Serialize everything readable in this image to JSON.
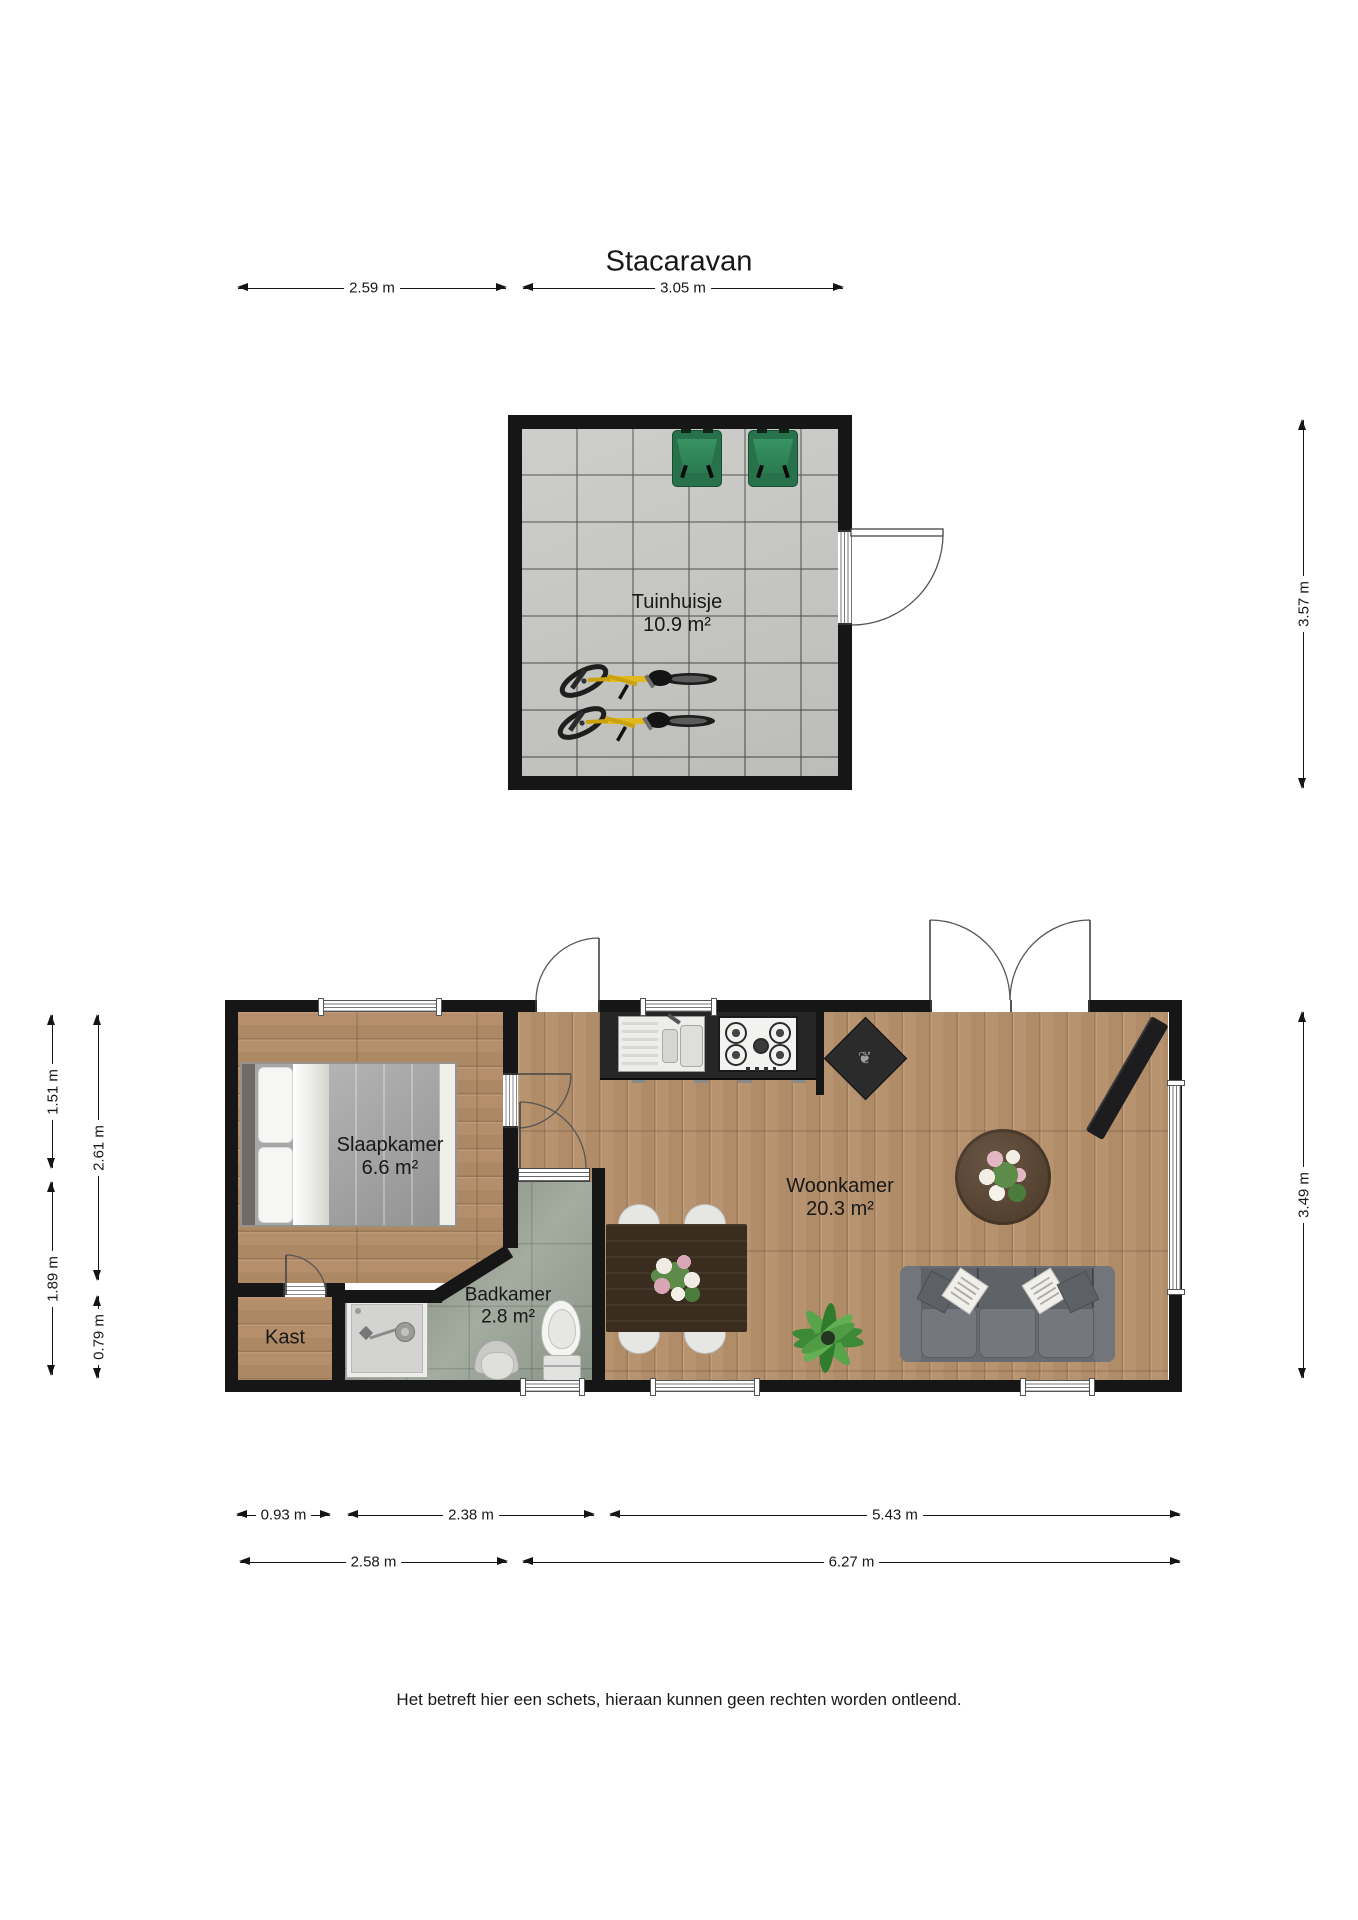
{
  "title": "Stacaravan",
  "disclaimer": "Het betreft hier een schets, hieraan kunnen geen rechten worden ontleend.",
  "rooms": {
    "tuinhuisje": {
      "name": "Tuinhuisje",
      "area": "10.9 m²"
    },
    "slaapkamer": {
      "name": "Slaapkamer",
      "area": "6.6 m²"
    },
    "woonkamer": {
      "name": "Woonkamer",
      "area": "20.3 m²"
    },
    "badkamer": {
      "name": "Badkamer",
      "area": "2.8 m²"
    },
    "kast": {
      "name": "Kast"
    }
  },
  "dimensions": {
    "top": [
      "2.59 m",
      "3.05 m"
    ],
    "tuinhuisje_height": "3.57 m",
    "main_height": "3.49 m",
    "left_outer": [
      "1.51 m",
      "1.89 m"
    ],
    "left_inner": [
      "2.61 m",
      "0.79 m"
    ],
    "bottom_row1": [
      "0.93 m",
      "2.38 m",
      "5.43 m"
    ],
    "bottom_row2": [
      "2.58 m",
      "6.27 m"
    ]
  },
  "furniture_icons": [
    "double-bed",
    "shower",
    "toilet",
    "bathroom-chair",
    "kitchen-counter",
    "kitchen-sink",
    "gas-hob",
    "fireplace-stove",
    "dining-table",
    "dining-chair",
    "flower-centerpiece",
    "coffee-table",
    "flower-bouquet",
    "sofa",
    "throw-pillow",
    "floor-plant",
    "tv",
    "wheelie-bin",
    "bicycle",
    "door",
    "window"
  ],
  "colors": {
    "wall": "#161616",
    "wood_floor": "#b5906c",
    "bathroom_tile": "#99a295",
    "paver_floor": "#c8c8c5",
    "bin_green": "#27714b",
    "bike_yellow": "#e3b71f",
    "sofa_gray": "#686b70",
    "table_brown": "#3a2d20"
  }
}
